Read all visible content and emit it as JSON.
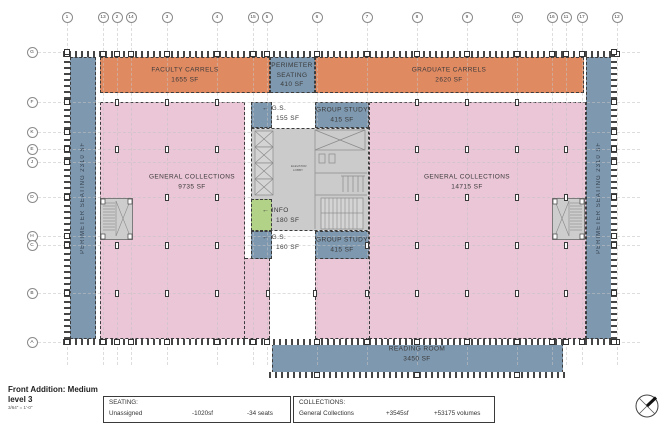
{
  "title_block": {
    "line1": "Front Addition: Medium",
    "line2": "level 3",
    "scale": "3/64\" = 1'-0\""
  },
  "plan": {
    "grid": {
      "top": [
        {
          "label": "1",
          "x": 67
        },
        {
          "label": "13",
          "x": 103
        },
        {
          "label": "2",
          "x": 117
        },
        {
          "label": "14",
          "x": 131
        },
        {
          "label": "3",
          "x": 167
        },
        {
          "label": "4",
          "x": 217
        },
        {
          "label": "15",
          "x": 253
        },
        {
          "label": "5",
          "x": 267
        },
        {
          "label": "6",
          "x": 317
        },
        {
          "label": "7",
          "x": 367
        },
        {
          "label": "8",
          "x": 417
        },
        {
          "label": "9",
          "x": 467
        },
        {
          "label": "10",
          "x": 517
        },
        {
          "label": "16",
          "x": 552
        },
        {
          "label": "11",
          "x": 566
        },
        {
          "label": "17",
          "x": 582
        },
        {
          "label": "12",
          "x": 617
        }
      ],
      "left": [
        {
          "label": "G",
          "y": 52
        },
        {
          "label": "F",
          "y": 102
        },
        {
          "label": "K",
          "y": 132
        },
        {
          "label": "E",
          "y": 149
        },
        {
          "label": "J",
          "y": 162
        },
        {
          "label": "D",
          "y": 197
        },
        {
          "label": "H",
          "y": 236
        },
        {
          "label": "C",
          "y": 245
        },
        {
          "label": "B",
          "y": 293
        },
        {
          "label": "A",
          "y": 342
        }
      ]
    },
    "column_markers": [
      [
        117,
        102
      ],
      [
        167,
        102
      ],
      [
        217,
        102
      ],
      [
        417,
        102
      ],
      [
        467,
        102
      ],
      [
        517,
        102
      ],
      [
        117,
        149
      ],
      [
        167,
        149
      ],
      [
        217,
        149
      ],
      [
        417,
        149
      ],
      [
        467,
        149
      ],
      [
        517,
        149
      ],
      [
        566,
        149
      ],
      [
        167,
        197
      ],
      [
        217,
        197
      ],
      [
        417,
        197
      ],
      [
        467,
        197
      ],
      [
        517,
        197
      ],
      [
        566,
        197
      ],
      [
        117,
        245
      ],
      [
        167,
        245
      ],
      [
        217,
        245
      ],
      [
        367,
        245
      ],
      [
        417,
        245
      ],
      [
        467,
        245
      ],
      [
        517,
        245
      ],
      [
        566,
        245
      ],
      [
        117,
        293
      ],
      [
        167,
        293
      ],
      [
        217,
        293
      ],
      [
        268,
        293
      ],
      [
        315,
        293
      ],
      [
        367,
        293
      ],
      [
        417,
        293
      ],
      [
        467,
        293
      ],
      [
        517,
        293
      ],
      [
        566,
        293
      ]
    ],
    "rr_wall_squares": [
      317,
      417,
      517
    ],
    "zones": {
      "faculty_carrels": {
        "name": "FACULTY CARRELS",
        "sf": "1655 SF"
      },
      "perimeter_seating_top": {
        "line1": "PERIMETER",
        "line2": "SEATING",
        "line3": "410 SF"
      },
      "graduate_carrels": {
        "name": "GRADUATE CARRELS",
        "sf": "2620 SF"
      },
      "general_collections_left": {
        "name": "GENERAL COLLECTIONS",
        "sf": "9735 SF"
      },
      "general_collections_right": {
        "name": "GENERAL COLLECTIONS",
        "sf": "14715 SF"
      },
      "group_study_top": {
        "name": "GROUP STUDY",
        "sf": "415 SF"
      },
      "group_study_bottom": {
        "name": "GROUP STUDY",
        "sf": "415 SF"
      },
      "gs_top": {
        "name": "G.S.",
        "sf": "155 SF"
      },
      "gs_bottom": {
        "name": "G.S.",
        "sf": "160 SF"
      },
      "info": {
        "name": "INFO",
        "sf": "180 SF"
      },
      "reading_room": {
        "name": "READING ROOM",
        "sf": "3450 SF"
      },
      "perimeter_seating_left": {
        "label": "PERIMETER SEATING 2310 SF"
      },
      "perimeter_seating_right": {
        "label": "PERIMETER SEATING 2310 SF"
      },
      "core": {
        "line1": "ELEVATOR",
        "line2": "LOBBY"
      }
    },
    "icons": {
      "leader_arrow": "←",
      "north_arrow": "north-arrow"
    }
  },
  "legend": {
    "seating": {
      "heading": "SEATING:",
      "row": {
        "name": "Unassigned",
        "sf": "-1020sf",
        "detail": "-34 seats"
      }
    },
    "collections": {
      "heading": "COLLECTIONS:",
      "row": {
        "name": "General Collections",
        "sf": "+3545sf",
        "detail": "+53175 volumes"
      }
    }
  },
  "colors": {
    "orange": "#E08A62",
    "pink": "#EBC6D6",
    "blue": "#7E98AF",
    "green": "#B2D288",
    "core_gray": "#CBCBCB",
    "wall": "#454545",
    "text": "#3A3A3A"
  }
}
